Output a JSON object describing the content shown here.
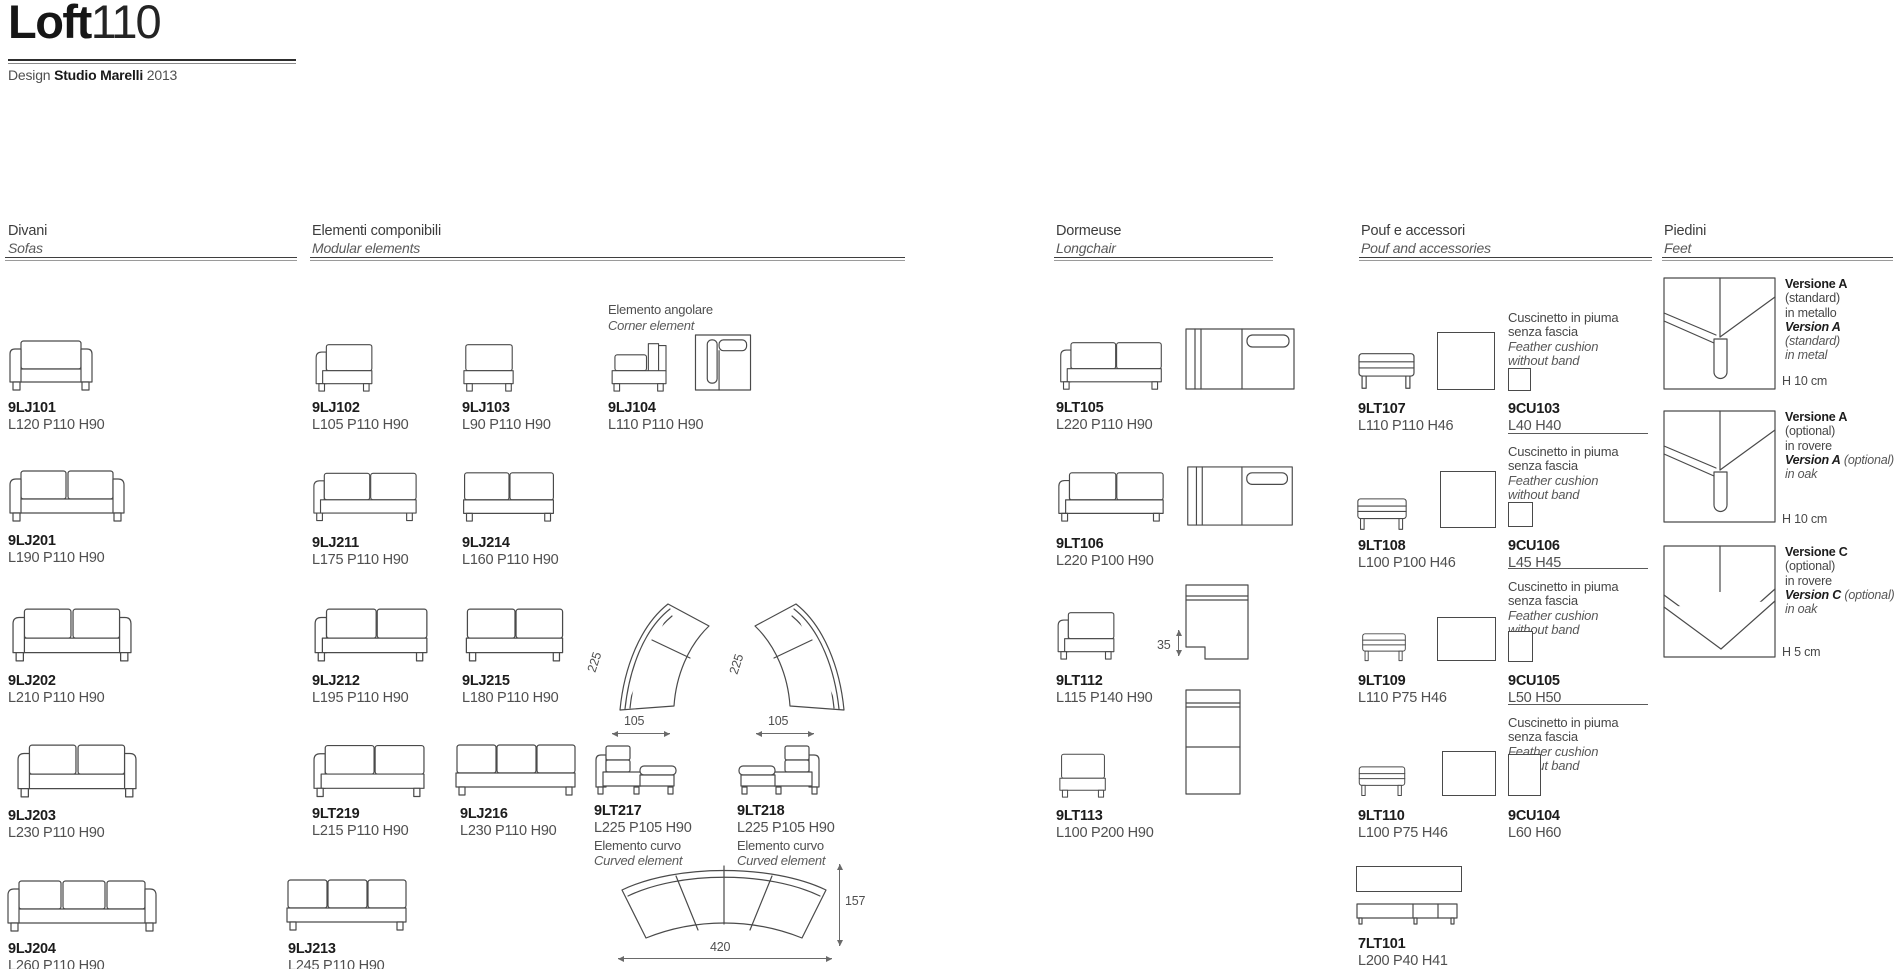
{
  "header": {
    "title_bold": "Loft",
    "title_light": "110",
    "credit_prefix": "Design ",
    "credit_studio": "Studio Marelli",
    "credit_year": " 2013"
  },
  "sections": {
    "divani": {
      "it": "Divani",
      "en": "Sofas"
    },
    "componibili": {
      "it": "Elementi componibili",
      "en": "Modular elements"
    },
    "dormeuse": {
      "it": "Dormeuse",
      "en": "Longchair"
    },
    "pouf": {
      "it": "Pouf e accessori",
      "en": "Pouf and accessories"
    },
    "piedini": {
      "it": "Piedini",
      "en": "Feet"
    }
  },
  "divani": [
    {
      "code": "9LJ101",
      "dims": "L120 P110 H90"
    },
    {
      "code": "9LJ201",
      "dims": "L190 P110 H90"
    },
    {
      "code": "9LJ202",
      "dims": "L210 P110 H90"
    },
    {
      "code": "9LJ203",
      "dims": "L230 P110 H90"
    },
    {
      "code": "9LJ204",
      "dims": "L260 P110 H90"
    }
  ],
  "componibili": {
    "a": [
      {
        "code": "9LJ102",
        "dims": "L105 P110 H90"
      },
      {
        "code": "9LJ211",
        "dims": "L175 P110 H90"
      },
      {
        "code": "9LJ212",
        "dims": "L195 P110 H90"
      },
      {
        "code": "9LT219",
        "dims": "L215 P110 H90"
      },
      {
        "code": "9LJ213",
        "dims": "L245 P110 H90"
      }
    ],
    "b": [
      {
        "code": "9LJ103",
        "dims": "L90 P110 H90"
      },
      {
        "code": "9LJ214",
        "dims": "L160 P110 H90"
      },
      {
        "code": "9LJ215",
        "dims": "L180 P110 H90"
      },
      {
        "code": "9LJ216",
        "dims": "L230 P110 H90"
      }
    ],
    "corner_note_it": "Elemento angolare",
    "corner_note_en": "Corner element",
    "corner": {
      "code": "9LJ104",
      "dims": "L110 P110 H90"
    },
    "curved_left": {
      "code": "9LT217",
      "dims": "L225 P105 H90",
      "note_it": "Elemento curvo",
      "note_en": "Curved element"
    },
    "curved_right": {
      "code": "9LT218",
      "dims": "L225 P105 H90",
      "note_it": "Elemento curvo",
      "note_en": "Curved element"
    },
    "dim_arc": "225",
    "dim_w": "105",
    "comp_h": "157",
    "comp_w": "420"
  },
  "dormeuse": [
    {
      "code": "9LT105",
      "dims": "L220 P110 H90"
    },
    {
      "code": "9LT106",
      "dims": "L220 P100 H90"
    },
    {
      "code": "9LT112",
      "dims": "L115 P140 H90"
    },
    {
      "code": "9LT113",
      "dims": "L100 P200 H90"
    }
  ],
  "dormeuse_dim": "35",
  "pouf": [
    {
      "code": "9LT107",
      "dims": "L110 P110 H46",
      "cu_code": "9CU103",
      "cu_dims": "L40 H40"
    },
    {
      "code": "9LT108",
      "dims": "L100 P100 H46",
      "cu_code": "9CU106",
      "cu_dims": "L45 H45"
    },
    {
      "code": "9LT109",
      "dims": "L110 P75 H46",
      "cu_code": "9CU105",
      "cu_dims": "L50 H50"
    },
    {
      "code": "9LT110",
      "dims": "L100 P75 H46",
      "cu_code": "9CU104",
      "cu_dims": "L60 H60"
    }
  ],
  "cushion_note": {
    "it1": "Cuscinetto in piuma",
    "it2": "senza fascia",
    "en1": "Feather cushion",
    "en2": "without band"
  },
  "bench": {
    "code": "7LT101",
    "dims": "L200 P40 H41"
  },
  "feet": [
    {
      "it_name": "Versione A",
      "it_qual": " (standard)",
      "it_mat": "in metallo",
      "en_name": "Version A",
      "en_qual": " (standard)",
      "en_mat": "in metal",
      "h": "H 10 cm"
    },
    {
      "it_name": "Versione A",
      "it_qual": " (optional)",
      "it_mat": "in rovere",
      "en_name": "Version A",
      "en_qual": " (optional)",
      "en_mat": "in oak",
      "h": "H 10 cm"
    },
    {
      "it_name": "Versione C",
      "it_qual": " (optional)",
      "it_mat": "in rovere",
      "en_name": "Version C",
      "en_qual": " (optional)",
      "en_mat": "in oak",
      "h": "H 5 cm"
    }
  ],
  "colors": {
    "ink": "#3c3c3c",
    "ink_dark": "#1c1c1c",
    "line": "#4a4a4a"
  }
}
